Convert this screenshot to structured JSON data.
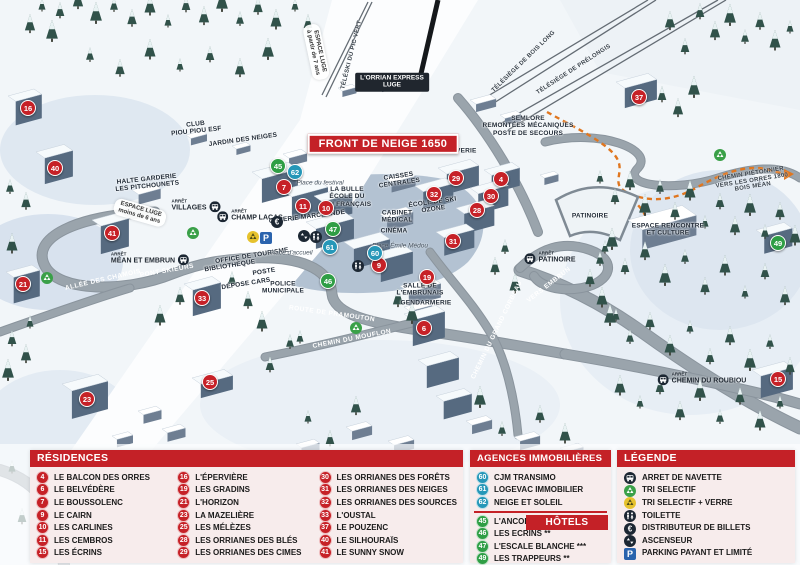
{
  "colors": {
    "residence": "#c62127",
    "agency": "#2697b8",
    "hotel": "#2f9e45",
    "header_red": "#c42127",
    "parking_blue": "#2a63ad",
    "recycle_green": "#3aa048",
    "recycle_yellow": "#e6c22d",
    "dark_icon": "#1c2733",
    "trail_orange": "#e0761f"
  },
  "map": {
    "banner": "FRONT DE NEIGE 1650",
    "stop_prefix": "ARRÊT",
    "markers": [
      {
        "n": "4",
        "type": "residence",
        "x": 501,
        "y": 179
      },
      {
        "n": "6",
        "type": "residence",
        "x": 424,
        "y": 328
      },
      {
        "n": "7",
        "type": "residence",
        "x": 284,
        "y": 187
      },
      {
        "n": "9",
        "type": "residence",
        "x": 379,
        "y": 265
      },
      {
        "n": "10",
        "type": "residence",
        "x": 326,
        "y": 208
      },
      {
        "n": "11",
        "type": "residence",
        "x": 303,
        "y": 206
      },
      {
        "n": "15",
        "type": "residence",
        "x": 778,
        "y": 379
      },
      {
        "n": "16",
        "type": "residence",
        "x": 28,
        "y": 108
      },
      {
        "n": "19",
        "type": "residence",
        "x": 427,
        "y": 277
      },
      {
        "n": "21",
        "type": "residence",
        "x": 23,
        "y": 284
      },
      {
        "n": "23",
        "type": "residence",
        "x": 87,
        "y": 399
      },
      {
        "n": "25",
        "type": "residence",
        "x": 210,
        "y": 382
      },
      {
        "n": "28",
        "type": "residence",
        "x": 477,
        "y": 210
      },
      {
        "n": "29",
        "type": "residence",
        "x": 456,
        "y": 178
      },
      {
        "n": "30",
        "type": "residence",
        "x": 491,
        "y": 196
      },
      {
        "n": "31",
        "type": "residence",
        "x": 453,
        "y": 241
      },
      {
        "n": "32",
        "type": "residence",
        "x": 434,
        "y": 194
      },
      {
        "n": "33",
        "type": "residence",
        "x": 202,
        "y": 298
      },
      {
        "n": "37",
        "type": "residence",
        "x": 639,
        "y": 97
      },
      {
        "n": "40",
        "type": "residence",
        "x": 55,
        "y": 168
      },
      {
        "n": "41",
        "type": "residence",
        "x": 112,
        "y": 233
      },
      {
        "n": "60",
        "type": "agency",
        "x": 375,
        "y": 253
      },
      {
        "n": "61",
        "type": "agency",
        "x": 330,
        "y": 247
      },
      {
        "n": "62",
        "type": "agency",
        "x": 295,
        "y": 172
      },
      {
        "n": "45",
        "type": "hotel",
        "x": 278,
        "y": 166
      },
      {
        "n": "46",
        "type": "hotel",
        "x": 328,
        "y": 281
      },
      {
        "n": "47",
        "type": "hotel",
        "x": 333,
        "y": 229
      },
      {
        "n": "49",
        "type": "hotel",
        "x": 778,
        "y": 243
      }
    ],
    "labels": [
      {
        "t": "FRONT DE NEIGE 1650",
        "x": 383,
        "y": 144,
        "r": 0,
        "c": "banner"
      },
      {
        "t": "L'ORRIAN EXPRESS|LUGE",
        "x": 392,
        "y": 82,
        "r": 0,
        "c": "tag"
      },
      {
        "t": "ESPACE LUGE|à partir de 7 ans",
        "x": 316,
        "y": 52,
        "r": 78,
        "c": "strip"
      },
      {
        "t": "ESPACE LUGE|moins de 6 ans",
        "x": 140,
        "y": 213,
        "r": 16,
        "c": "strip"
      },
      {
        "t": "TÉLÉSKI DU PIC VERT",
        "x": 352,
        "y": 55,
        "r": -76,
        "c": "lift"
      },
      {
        "t": "TÉLÉSIÈGE DE BOIS LONG",
        "x": 524,
        "y": 62,
        "r": -44,
        "c": "lift"
      },
      {
        "t": "TÉLÉSIÈGE DE PRÉLONGIS",
        "x": 574,
        "y": 70,
        "r": -33,
        "c": "lift"
      },
      {
        "t": "CHEMIN PIÉTONNIER|VERS LES ORRES 1800|BOIS MÉAN",
        "x": 752,
        "y": 181,
        "r": -9,
        "c": "lift"
      },
      {
        "t": "CLUB|PIOU PIOU ESF",
        "x": 196,
        "y": 128,
        "r": -6,
        "c": "bld"
      },
      {
        "t": "JARDIN DES NEIGES",
        "x": 243,
        "y": 140,
        "r": -8,
        "c": "bld"
      },
      {
        "t": "HALTE GARDERIE|LES PITCHOUNETS",
        "x": 147,
        "y": 183,
        "r": -6,
        "c": "bld"
      },
      {
        "t": "SEMLORE|REMONTÉES MÉCANIQUES|POSTE DE SECOURS",
        "x": 528,
        "y": 126,
        "r": 0,
        "c": "bld"
      },
      {
        "t": "CAISSES|CENTRALES",
        "x": 399,
        "y": 180,
        "r": -8,
        "c": "bld"
      },
      {
        "t": "LA BULLE|ÉCOLE DU|SKI FRANÇAIS",
        "x": 347,
        "y": 197,
        "r": 0,
        "c": "bld"
      },
      {
        "t": "GALERIE MARCHANDE",
        "x": 307,
        "y": 217,
        "r": -7,
        "c": "bld"
      },
      {
        "t": "ÉCOLE DE SKI|OZONE",
        "x": 433,
        "y": 206,
        "r": -8,
        "c": "bld"
      },
      {
        "t": "CABINET|MÉDICAL",
        "x": 397,
        "y": 217,
        "r": 0,
        "c": "bld"
      },
      {
        "t": "CINÉMA",
        "x": 394,
        "y": 231,
        "r": 0,
        "c": "bld"
      },
      {
        "t": "LAVERIE",
        "x": 462,
        "y": 151,
        "r": 0,
        "c": "bld"
      },
      {
        "t": "BIBLIOTHÈQUE",
        "x": 230,
        "y": 266,
        "r": -9,
        "c": "bld"
      },
      {
        "t": "OFFICE DE TOURISME",
        "x": 252,
        "y": 256,
        "r": -9,
        "c": "bld"
      },
      {
        "t": "POSTE",
        "x": 264,
        "y": 272,
        "r": -9,
        "c": "bld"
      },
      {
        "t": "DÉPOSE CARS",
        "x": 246,
        "y": 284,
        "r": -9,
        "c": "bld"
      },
      {
        "t": "POLICE|MUNICIPALE",
        "x": 283,
        "y": 288,
        "r": 0,
        "c": "bld"
      },
      {
        "t": "SALLE DE|L'EMBRUNAIS",
        "x": 420,
        "y": 290,
        "r": 0,
        "c": "bld"
      },
      {
        "t": "GENDARMERIE",
        "x": 426,
        "y": 303,
        "r": 0,
        "c": "bld"
      },
      {
        "t": "PATINOIRE",
        "x": 590,
        "y": 216,
        "r": 0,
        "c": "bld"
      },
      {
        "t": "ESPACE RENCONTRE|ET CULTURE",
        "x": 668,
        "y": 230,
        "r": 0,
        "c": "bld"
      },
      {
        "t": "ALLÉE DES CHAMOIS",
        "x": 103,
        "y": 280,
        "r": -13,
        "c": "road"
      },
      {
        "t": "PONT SKIEURS",
        "x": 167,
        "y": 271,
        "r": -10,
        "c": "road"
      },
      {
        "t": "ROUTE DE PRAMOUTON",
        "x": 332,
        "y": 314,
        "r": 8,
        "c": "road"
      },
      {
        "t": "CHEMIN DU MOUFLON",
        "x": 352,
        "y": 339,
        "r": -11,
        "c": "road"
      },
      {
        "t": "CHEMIN DU GRAND CORBEAU",
        "x": 497,
        "y": 330,
        "r": -64,
        "c": "road"
      },
      {
        "t": "VERS EMBRUN",
        "x": 549,
        "y": 285,
        "r": -38,
        "c": "road"
      },
      {
        "t": "Place du festival",
        "x": 320,
        "y": 183,
        "r": 0,
        "c": "place"
      },
      {
        "t": "Place d'accueil",
        "x": 291,
        "y": 253,
        "r": 0,
        "c": "place"
      },
      {
        "t": "Place Émile Médou",
        "x": 400,
        "y": 246,
        "r": 0,
        "c": "place"
      }
    ],
    "bus_stops": [
      {
        "name": "VILLAGES",
        "x": 196,
        "y": 205,
        "side": "right"
      },
      {
        "name": "CHAMP LACAS",
        "x": 250,
        "y": 215,
        "side": "left"
      },
      {
        "name": "MÉAN ET EMBRUN",
        "x": 150,
        "y": 258,
        "side": "right"
      },
      {
        "name": "PATINOIRE",
        "x": 550,
        "y": 257,
        "side": "left"
      },
      {
        "name": "CHEMIN DU ROUBIOU",
        "x": 702,
        "y": 378,
        "side": "left"
      }
    ],
    "icons": [
      {
        "t": "recycle-green",
        "x": 193,
        "y": 233
      },
      {
        "t": "recycle-green",
        "x": 356,
        "y": 328
      },
      {
        "t": "recycle-green",
        "x": 720,
        "y": 155
      },
      {
        "t": "recycle-green",
        "x": 47,
        "y": 278
      },
      {
        "t": "recycle-yellow",
        "x": 253,
        "y": 237
      },
      {
        "t": "parking",
        "x": 266,
        "y": 238
      },
      {
        "t": "euro",
        "x": 277,
        "y": 222
      },
      {
        "t": "toilet",
        "x": 316,
        "y": 237
      },
      {
        "t": "toilet",
        "x": 358,
        "y": 266
      },
      {
        "t": "elevator",
        "x": 304,
        "y": 236
      }
    ]
  },
  "panels": {
    "residences": {
      "title": "RÉSIDENCES",
      "columns": [
        [
          {
            "n": "4",
            "label": "LE BALCON DES ORRES"
          },
          {
            "n": "6",
            "label": "LE BELVÉDÈRE"
          },
          {
            "n": "7",
            "label": "LE BOUSSOLENC"
          },
          {
            "n": "9",
            "label": "LE CAIRN"
          },
          {
            "n": "10",
            "label": "LES CARLINES"
          },
          {
            "n": "11",
            "label": "LES CEMBROS"
          },
          {
            "n": "15",
            "label": "LES ÉCRINS"
          }
        ],
        [
          {
            "n": "16",
            "label": "L'ÉPERVIÈRE"
          },
          {
            "n": "19",
            "label": "LES GRADINS"
          },
          {
            "n": "21",
            "label": "L'HORIZON"
          },
          {
            "n": "23",
            "label": "LA MAZELIÈRE"
          },
          {
            "n": "25",
            "label": "LES MÉLÈZES"
          },
          {
            "n": "28",
            "label": "LES ORRIANES DES BLÉS"
          },
          {
            "n": "29",
            "label": "LES ORRIANES DES CIMES"
          }
        ],
        [
          {
            "n": "30",
            "label": "LES ORRIANES DES FORÊTS"
          },
          {
            "n": "31",
            "label": "LES ORRIANES DES NEIGES"
          },
          {
            "n": "32",
            "label": "LES ORRIANES DES SOURCES"
          },
          {
            "n": "33",
            "label": "L'OUSTAL"
          },
          {
            "n": "37",
            "label": "LE POUZENC"
          },
          {
            "n": "40",
            "label": "LE SILHOURAÏS"
          },
          {
            "n": "41",
            "label": "LE SUNNY SNOW"
          }
        ]
      ]
    },
    "agences": {
      "title": "AGENCES IMMOBILIÈRES",
      "items": [
        {
          "n": "60",
          "label": "CJM TRANSIMO"
        },
        {
          "n": "61",
          "label": "LOGEVAC IMMOBILIER"
        },
        {
          "n": "62",
          "label": "NEIGE ET SOLEIL"
        }
      ]
    },
    "hotels": {
      "title": "HÔTELS",
      "items": [
        {
          "n": "45",
          "label": "L'ANCOLIE **"
        },
        {
          "n": "46",
          "label": "LES ECRINS **"
        },
        {
          "n": "47",
          "label": "L'ESCALE BLANCHE ***"
        },
        {
          "n": "49",
          "label": "LES TRAPPEURS **"
        }
      ]
    },
    "legende": {
      "title": "LÉGENDE",
      "items": [
        {
          "icon": "bus",
          "label": "ARRET DE NAVETTE"
        },
        {
          "icon": "recycle-green",
          "label": "TRI SELECTIF"
        },
        {
          "icon": "recycle-yellow",
          "label": "TRI SELECTIF + VERRE"
        },
        {
          "icon": "toilet",
          "label": "TOILETTE"
        },
        {
          "icon": "euro",
          "label": "DISTRIBUTEUR DE BILLETS"
        },
        {
          "icon": "elevator",
          "label": "ASCENSEUR"
        },
        {
          "icon": "parking",
          "label": "PARKING PAYANT ET LIMITÉ"
        }
      ]
    }
  }
}
